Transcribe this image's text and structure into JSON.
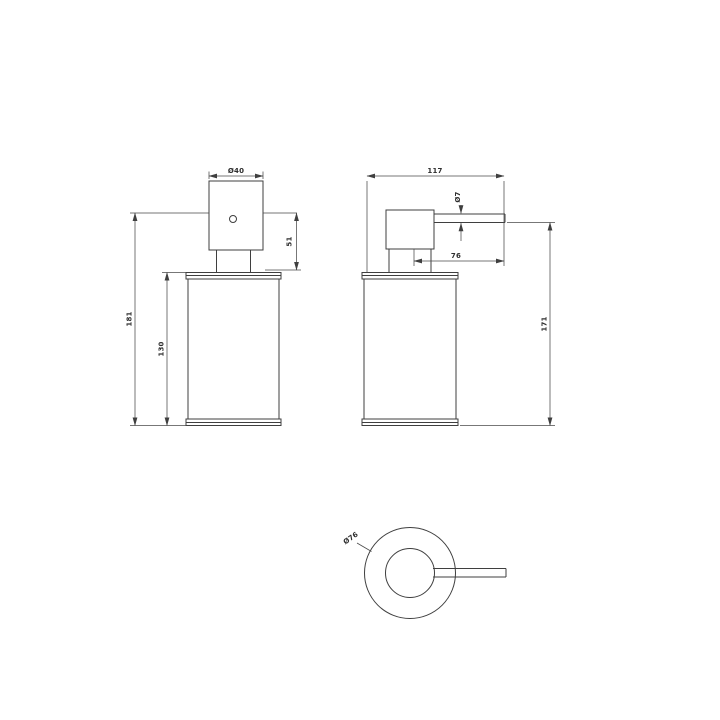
{
  "page": {
    "background_color": "#ffffff",
    "line_color": "#3f3f3f"
  },
  "drawing": {
    "name": "Freestanding soap dispenser - dimensioned technical drawing (front, side and top views)",
    "front_view": {
      "pump_diameter": "Ø40",
      "pump_height": "51",
      "total_height": "181",
      "body_height": "130"
    },
    "side_view": {
      "overall_depth": "117",
      "spout_diameter": "Ø7",
      "spout_projection": "76",
      "spout_height": "171"
    },
    "top_view": {
      "base_diameter": "Ø76"
    }
  }
}
